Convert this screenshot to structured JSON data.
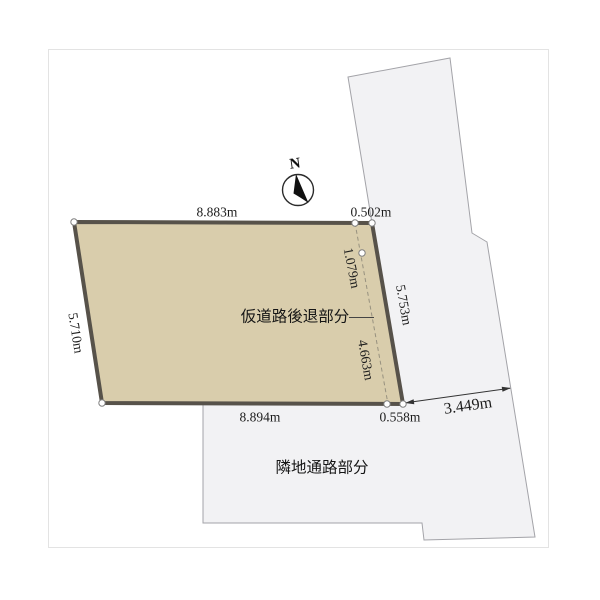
{
  "diagram": {
    "north_label": "N",
    "area_labels": {
      "setback": "仮道路後退部分",
      "neighbor_passage": "隣地通路部分"
    },
    "dimensions": {
      "top_edge": "8.883m",
      "top_right_segment": "0.502m",
      "left_edge": "5.710m",
      "right_edge": "5.753m",
      "inner_upper_segment": "1.079m",
      "inner_lower_segment": "4.663m",
      "bottom_edge": "8.894m",
      "bottom_right_segment": "0.558m",
      "road_width": "3.449m"
    },
    "colors": {
      "parcel_fill": "#d9cdac",
      "parcel_border": "#57524a",
      "road_fill": "#f2f2f4",
      "road_border": "#a3a3a8",
      "frame_border": "#e3e3e3",
      "dashed_line": "#97917f",
      "text": "#1c1c1c"
    }
  }
}
